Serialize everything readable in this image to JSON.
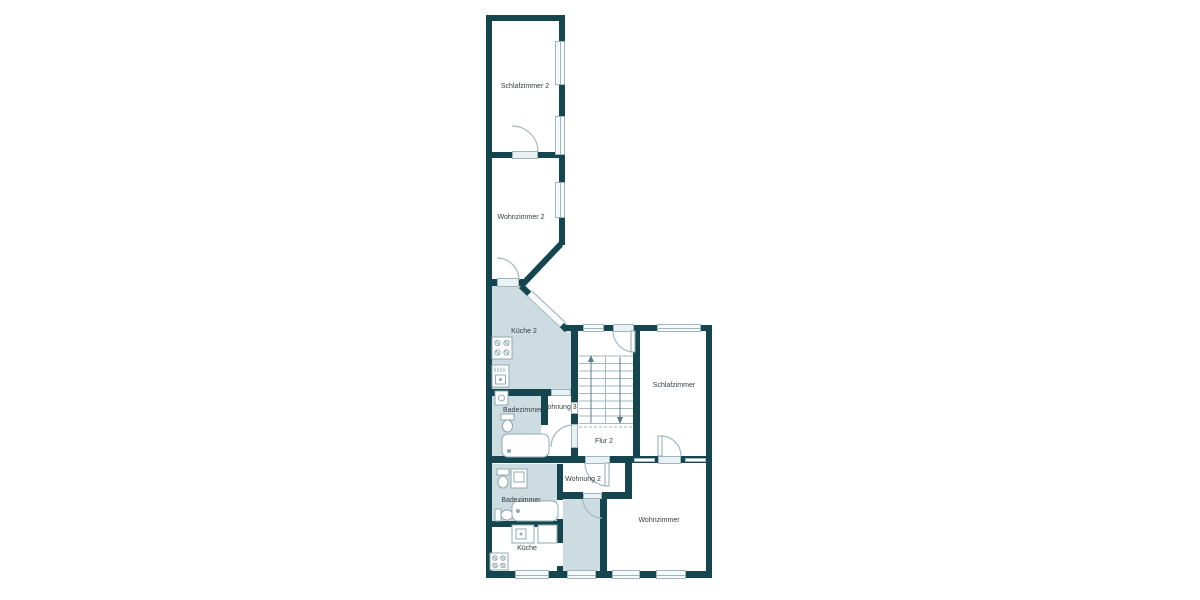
{
  "plan": {
    "type": "floor-plan",
    "language": "de"
  },
  "colors": {
    "wall": "#15464f",
    "room_fill": "#ccdce1",
    "line": "#9fb6bc",
    "window_fill": "#f7fafb",
    "text": "#343e42",
    "background": "#ffffff"
  },
  "rooms": {
    "schlafzimmer_2": {
      "label": "Schlafzimmer 2"
    },
    "wohnzimmer_2": {
      "label": "Wohnzimmer 2"
    },
    "kueche_2": {
      "label": "Küche 2"
    },
    "badezimmer_3": {
      "label": "Badezimmer"
    },
    "wohnung_3": {
      "label": "Wohnung 3"
    },
    "schlafzimmer": {
      "label": "Schlafzimmer"
    },
    "flur_2": {
      "label": "Flur 2"
    },
    "wohnung_2": {
      "label": "Wohnung 2"
    },
    "badezimmer_2": {
      "label": "Badezimmer"
    },
    "wohnzimmer": {
      "label": "Wohnzimmer"
    },
    "kueche": {
      "label": "Küche"
    }
  },
  "stairs": {
    "flights": 2,
    "treads_per_flight": 9,
    "direction_arrows": [
      "up",
      "down"
    ]
  },
  "icons": [
    "stove-icon",
    "kitchen-sink-icon",
    "washbasin-icon",
    "toilet-icon",
    "bathtub-icon",
    "bidet-icon",
    "cabinet-icon",
    "door-icon",
    "window-icon",
    "stairs-icon",
    "arrow-up-icon",
    "arrow-down-icon"
  ]
}
